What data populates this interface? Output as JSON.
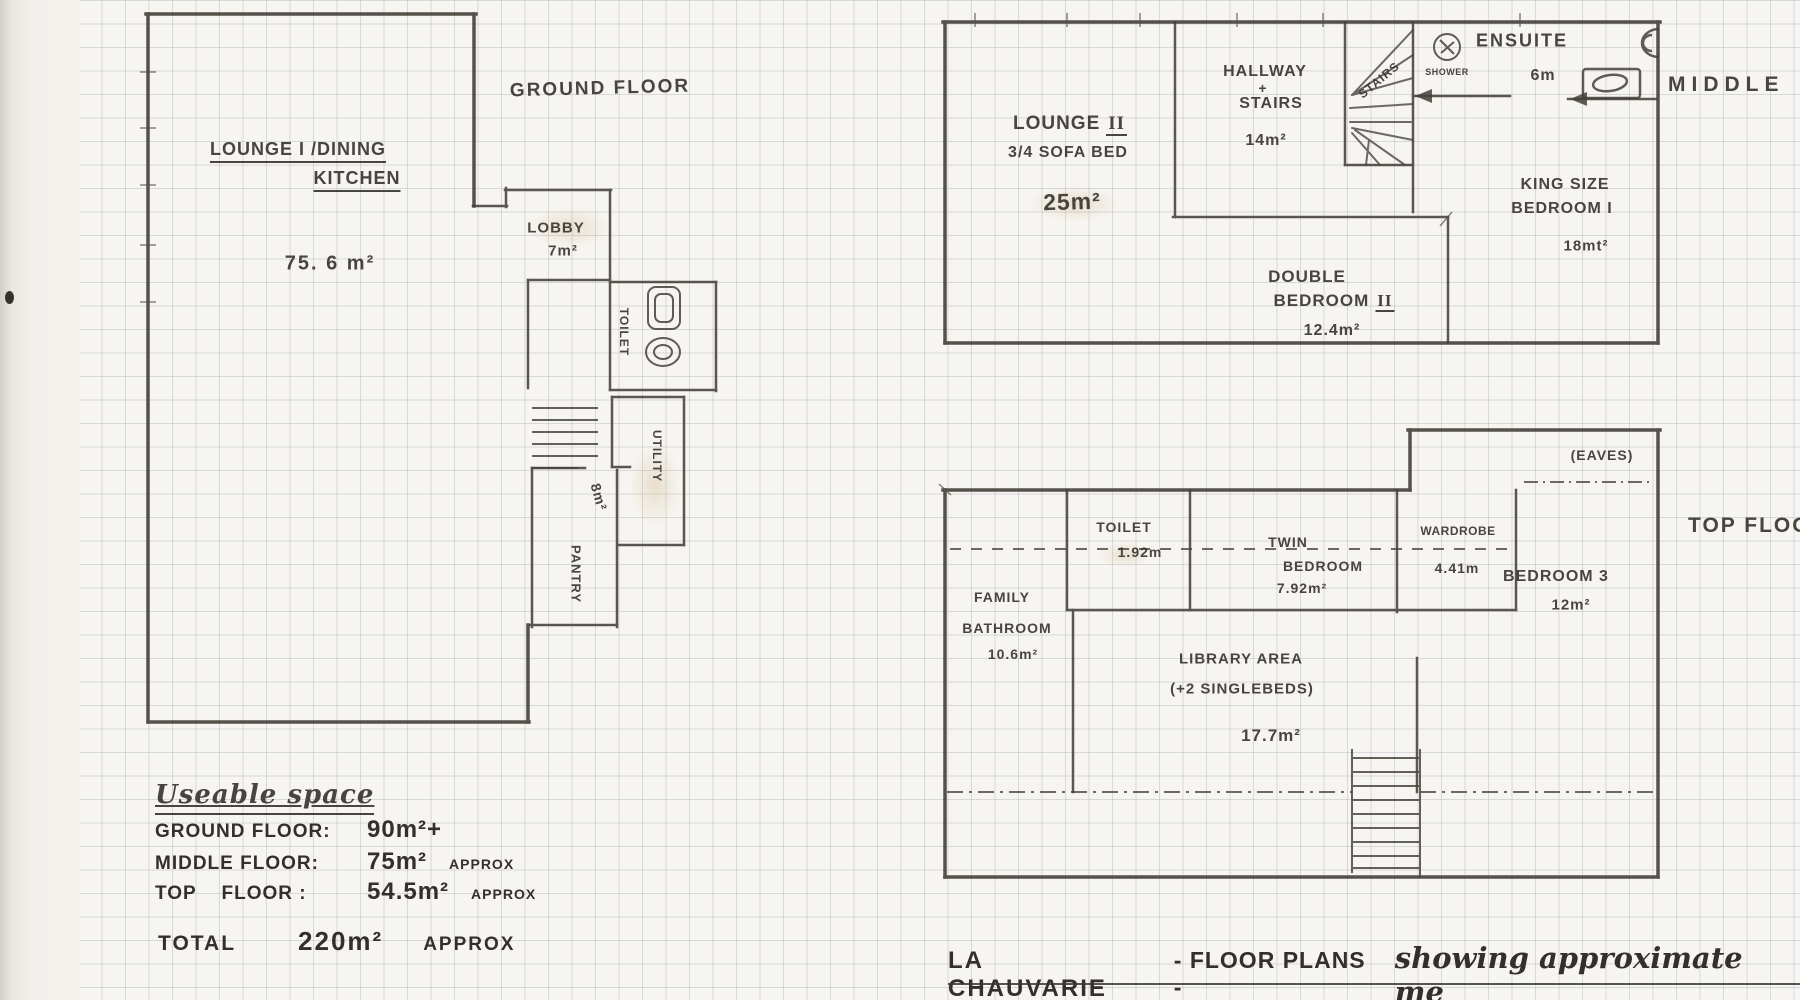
{
  "colors": {
    "pencil": "#3b3833",
    "paper": "#f7f5f1",
    "grid_line": "#aeb4be",
    "stain": "#c6aa7a"
  },
  "icons": {
    "shower": "circle-with-cross-marks",
    "ensuite_toilet": "c-shape-bowl",
    "ensuite_sink": "rect-with-oval-basin",
    "ground_toilet": "cistern-and-bowl",
    "stairs": "parallel-tread-lines"
  },
  "ground_floor": {
    "header": "GROUND FLOOR",
    "lounge_line1": "LOUNGE I /DINING",
    "lounge_line2": "KITCHEN",
    "lounge_area": "75. 6 m²",
    "lobby_name": "LOBBY",
    "lobby_area": "7m²",
    "toilet_name": "TOILET",
    "utility_name": "UTILITY",
    "utility_area": "8m²",
    "pantry_name": "PANTRY"
  },
  "middle_floor": {
    "floor_label": "MIDDLE",
    "lounge2_name": "LOUNGE",
    "lounge2_numeral": "II",
    "lounge2_sub": "3/4 SOFA BED",
    "lounge2_area": "25m²",
    "hallway_line1": "HALLWAY",
    "hallway_plus": "+",
    "hallway_line2": "STAIRS",
    "hallway_area": "14m²",
    "stairs_label": "STAIRS",
    "shower_label": "SHOWER",
    "ensuite_name": "ENSUITE",
    "ensuite_area": "6m",
    "king_line1": "KING SIZE",
    "king_line2": "BEDROOM I",
    "king_area": "18mt²",
    "double_line1": "DOUBLE",
    "double_line2": "BEDROOM",
    "double_numeral": "II",
    "double_area": "12.4m²"
  },
  "top_floor": {
    "floor_label": "TOP FLOOR",
    "toilet_name": "TOILET",
    "toilet_area": "1.92m",
    "twin_line1": "TWIN",
    "twin_line2": "BEDROOM",
    "twin_area": "7.92m²",
    "wardrobe_name": "WARDROBE",
    "wardrobe_area": "4.41m",
    "eaves_label": "(EAVES)",
    "family_line1": "FAMILY",
    "family_line2": "BATHROOM",
    "family_area": "10.6m²",
    "library_line1": "LIBRARY AREA",
    "library_line2": "(+2 SINGLEBEDS)",
    "library_area": "17.7m²",
    "bedroom3_name": "BEDROOM 3",
    "bedroom3_area": "12m²"
  },
  "summary": {
    "heading": "Useable space",
    "rows": [
      {
        "label": "GROUND FLOOR:",
        "value": "90m²+",
        "note": ""
      },
      {
        "label": "MIDDLE FLOOR:",
        "value": "75m²",
        "note": "APPROX"
      },
      {
        "label": "TOP    FLOOR :",
        "value": "54.5m²",
        "note": "APPROX"
      }
    ],
    "total_label": "TOTAL",
    "total_value": "220m²",
    "total_note": "APPROX"
  },
  "title": {
    "part1": "LA CHAUVARIE",
    "part2": "- FLOOR PLANS -",
    "part3": "showing approximate me"
  }
}
